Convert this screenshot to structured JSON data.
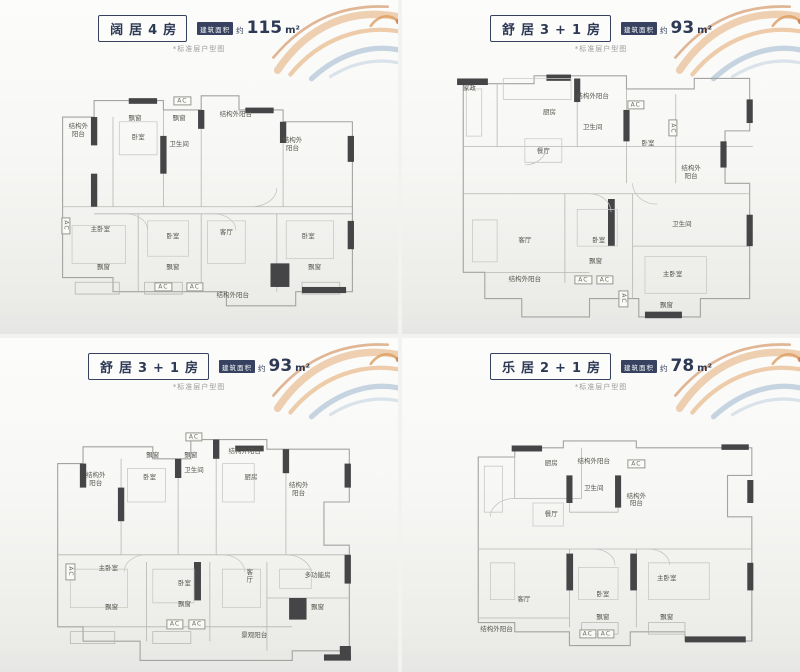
{
  "colors": {
    "navy": "#36425f",
    "wall_dark": "#454547",
    "line_gray": "#a3a3a1",
    "deco_orange": "#d9924f",
    "deco_blue": "#8fabc9"
  },
  "panels": [
    {
      "title": "阔居4房",
      "area_badge": "建筑面积",
      "area_approx": "约",
      "area_value": "115",
      "area_unit": "m²",
      "note": "*标准层户型图",
      "rooms": [
        {
          "label": "结构外\n阳台",
          "x": 9,
          "y": 20,
          "wrap": true
        },
        {
          "label": "飘窗",
          "x": 27,
          "y": 15
        },
        {
          "label": "飘窗",
          "x": 41,
          "y": 15
        },
        {
          "label": "AC",
          "x": 42,
          "y": 7,
          "box": true
        },
        {
          "label": "卧室",
          "x": 28,
          "y": 23
        },
        {
          "label": "卫生间",
          "x": 41,
          "y": 26
        },
        {
          "label": "结构外阳台",
          "x": 59,
          "y": 13
        },
        {
          "label": "结构外\n阳台",
          "x": 77,
          "y": 26,
          "wrap": true
        },
        {
          "label": "AC",
          "x": 5,
          "y": 60,
          "box": true,
          "v": true
        },
        {
          "label": "主卧室",
          "x": 16,
          "y": 62
        },
        {
          "label": "卧室",
          "x": 39,
          "y": 65
        },
        {
          "label": "客厅",
          "x": 56,
          "y": 63
        },
        {
          "label": "卧室",
          "x": 82,
          "y": 65
        },
        {
          "label": "飘窗",
          "x": 17,
          "y": 78
        },
        {
          "label": "飘窗",
          "x": 39,
          "y": 78
        },
        {
          "label": "飘窗",
          "x": 84,
          "y": 78
        },
        {
          "label": "AC",
          "x": 36,
          "y": 86,
          "box": true
        },
        {
          "label": "AC",
          "x": 46,
          "y": 86,
          "box": true
        },
        {
          "label": "结构外阳台",
          "x": 58,
          "y": 90
        }
      ]
    },
    {
      "title": "舒居3+1房",
      "area_badge": "建筑面积",
      "area_approx": "约",
      "area_value": "93",
      "area_unit": "m²",
      "note": "*标准层户型图",
      "rooms": [
        {
          "label": "家政",
          "x": 5,
          "y": 8
        },
        {
          "label": "厨房",
          "x": 31,
          "y": 17
        },
        {
          "label": "结构外阳台",
          "x": 45,
          "y": 11
        },
        {
          "label": "卫生间",
          "x": 45,
          "y": 23
        },
        {
          "label": "AC",
          "x": 59,
          "y": 14,
          "box": true
        },
        {
          "label": "卧室",
          "x": 63,
          "y": 29
        },
        {
          "label": "AC",
          "x": 71,
          "y": 23,
          "box": true,
          "v": true
        },
        {
          "label": "结构外\n阳台",
          "x": 77,
          "y": 40,
          "wrap": true
        },
        {
          "label": "餐厅",
          "x": 29,
          "y": 32
        },
        {
          "label": "客厅",
          "x": 23,
          "y": 66
        },
        {
          "label": "卧室",
          "x": 47,
          "y": 66
        },
        {
          "label": "飘窗",
          "x": 46,
          "y": 74
        },
        {
          "label": "卫生间",
          "x": 74,
          "y": 60
        },
        {
          "label": "主卧室",
          "x": 71,
          "y": 79
        },
        {
          "label": "飘窗",
          "x": 69,
          "y": 91
        },
        {
          "label": "AC",
          "x": 42,
          "y": 81,
          "box": true
        },
        {
          "label": "AC",
          "x": 49,
          "y": 81,
          "box": true
        },
        {
          "label": "结构外阳台",
          "x": 23,
          "y": 81
        },
        {
          "label": "AC",
          "x": 55,
          "y": 88,
          "box": true,
          "v": true
        }
      ]
    },
    {
      "title": "舒居3+1房",
      "area_badge": "建筑面积",
      "area_approx": "约",
      "area_value": "93",
      "area_unit": "m²",
      "note": "*标准层户型图",
      "rooms": [
        {
          "label": "AC",
          "x": 47,
          "y": 3,
          "box": true
        },
        {
          "label": "飘窗",
          "x": 34,
          "y": 11
        },
        {
          "label": "飘窗",
          "x": 46,
          "y": 11
        },
        {
          "label": "卧室",
          "x": 33,
          "y": 20
        },
        {
          "label": "卫生间",
          "x": 47,
          "y": 17
        },
        {
          "label": "结构外\n阳台",
          "x": 16,
          "y": 21,
          "wrap": true
        },
        {
          "label": "结构外阳台",
          "x": 63,
          "y": 9
        },
        {
          "label": "厨房",
          "x": 65,
          "y": 20
        },
        {
          "label": "结构外\n阳台",
          "x": 80,
          "y": 25,
          "wrap": true
        },
        {
          "label": "主卧室",
          "x": 20,
          "y": 58
        },
        {
          "label": "卧室",
          "x": 44,
          "y": 64
        },
        {
          "label": "飘窗",
          "x": 21,
          "y": 74
        },
        {
          "label": "飘窗",
          "x": 44,
          "y": 73
        },
        {
          "label": "AC",
          "x": 8,
          "y": 59,
          "box": true,
          "v": true
        },
        {
          "label": "AC",
          "x": 41,
          "y": 81,
          "box": true
        },
        {
          "label": "AC",
          "x": 48,
          "y": 81,
          "box": true
        },
        {
          "label": "客厅",
          "x": 64,
          "y": 61,
          "v": true
        },
        {
          "label": "多功能房",
          "x": 86,
          "y": 61
        },
        {
          "label": "飘窗",
          "x": 86,
          "y": 74
        },
        {
          "label": "景观阳台",
          "x": 66,
          "y": 86
        }
      ]
    },
    {
      "title": "乐居2+1房",
      "area_badge": "建筑面积",
      "area_approx": "约",
      "area_value": "78",
      "area_unit": "m²",
      "note": "*标准层户型图",
      "rooms": [
        {
          "label": "厨房",
          "x": 30,
          "y": 13
        },
        {
          "label": "结构外阳台",
          "x": 44,
          "y": 12
        },
        {
          "label": "卫生间",
          "x": 44,
          "y": 24
        },
        {
          "label": "AC",
          "x": 58,
          "y": 13,
          "box": true
        },
        {
          "label": "餐厅",
          "x": 30,
          "y": 35
        },
        {
          "label": "结构外\n阳台",
          "x": 58,
          "y": 29,
          "wrap": true
        },
        {
          "label": "客厅",
          "x": 21,
          "y": 72
        },
        {
          "label": "卧室",
          "x": 47,
          "y": 70
        },
        {
          "label": "主卧室",
          "x": 68,
          "y": 63
        },
        {
          "label": "飘窗",
          "x": 47,
          "y": 80
        },
        {
          "label": "飘窗",
          "x": 68,
          "y": 80
        },
        {
          "label": "AC",
          "x": 42,
          "y": 87,
          "box": true
        },
        {
          "label": "AC",
          "x": 48,
          "y": 87,
          "box": true
        },
        {
          "label": "结构外阳台",
          "x": 12,
          "y": 85
        }
      ]
    }
  ]
}
